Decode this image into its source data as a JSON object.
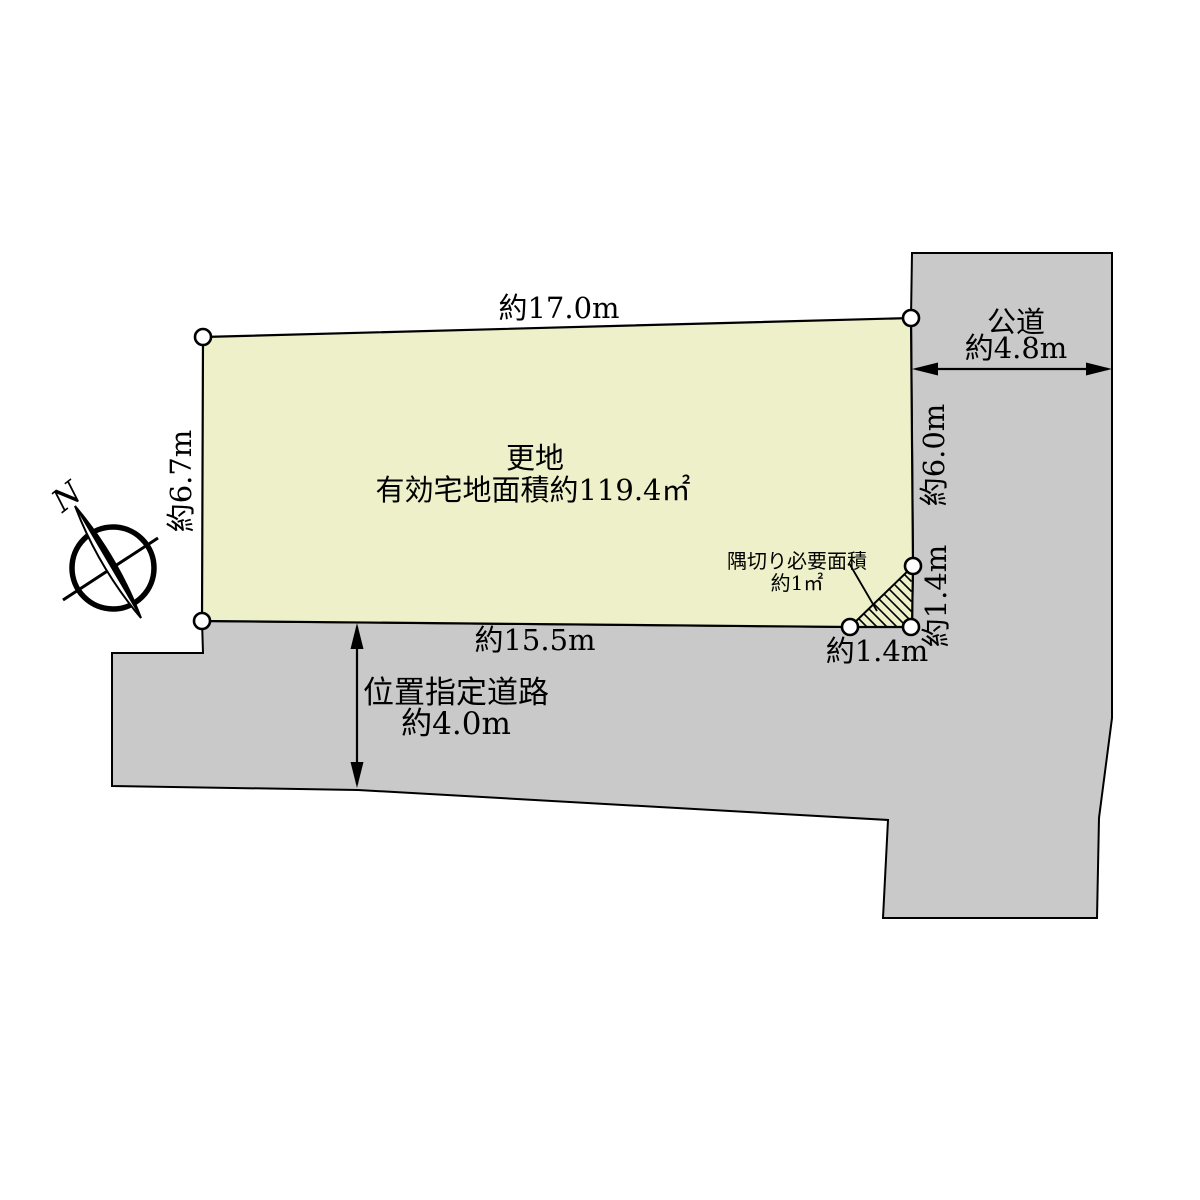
{
  "diagram": {
    "title": "土地区画図",
    "north_label": "N",
    "plot": {
      "status_label": "更地",
      "area_label": "有効宅地面積約119.4㎡"
    },
    "dimensions": {
      "top_edge": "約17.0m",
      "left_edge": "約6.7m",
      "right_edge_upper": "約6.0m",
      "right_corner_cut": "約1.4m",
      "bottom_corner_cut": "約1.4m",
      "bottom_edge": "約15.5m"
    },
    "corner_cut": {
      "label_line1": "隅切り必要面積",
      "label_line2": "約1㎡"
    },
    "roads": {
      "public_road": {
        "name": "公道",
        "width": "約4.8m"
      },
      "designated_road": {
        "name": "位置指定道路",
        "width": "約4.0m"
      }
    },
    "colors": {
      "plot_fill": "#edf0c8",
      "road_fill": "#c9c9ca",
      "line": "#000000"
    }
  }
}
